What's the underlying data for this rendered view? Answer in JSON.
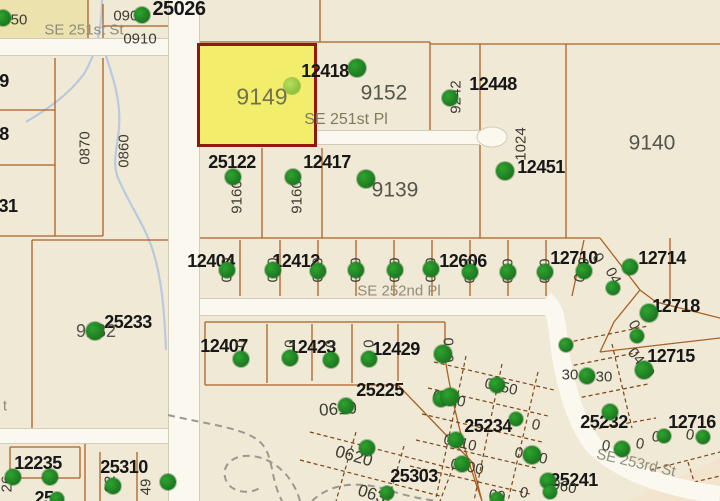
{
  "map": {
    "colors": {
      "background": "#f0e9d6",
      "parcel_line": "#aa6226",
      "road_fill": "#fbf8ef",
      "road_edge": "#d2cbb8",
      "stream": "#b9c9de",
      "highlight_fill": "#f2ee6b",
      "highlight_border": "#8d1a0f",
      "marker": "#1e8a1e",
      "marker_light": "#8ec63f",
      "label_bold": "#171717",
      "label_grey": "#55554a",
      "street": "#8f8c7a"
    },
    "selected_parcel": {
      "id": "9149",
      "x": 197,
      "y": 43,
      "w": 120,
      "h": 104
    },
    "labels": [
      {
        "t": "25026",
        "x": 179,
        "y": 9,
        "k": "p",
        "s": 20
      },
      {
        "t": "12418",
        "x": 325,
        "y": 71,
        "k": "p"
      },
      {
        "t": "12448",
        "x": 493,
        "y": 84,
        "k": "p"
      },
      {
        "t": "25122",
        "x": 232,
        "y": 162,
        "k": "p"
      },
      {
        "t": "12417",
        "x": 327,
        "y": 162,
        "k": "p"
      },
      {
        "t": "12451",
        "x": 541,
        "y": 167,
        "k": "p"
      },
      {
        "t": "12404",
        "x": 211,
        "y": 261,
        "k": "p"
      },
      {
        "t": "12412",
        "x": 296,
        "y": 261,
        "k": "p"
      },
      {
        "t": "12606",
        "x": 463,
        "y": 261,
        "k": "p"
      },
      {
        "t": "12710",
        "x": 574,
        "y": 258,
        "k": "p"
      },
      {
        "t": "12714",
        "x": 662,
        "y": 258,
        "k": "p"
      },
      {
        "t": "12718",
        "x": 676,
        "y": 306,
        "k": "p"
      },
      {
        "t": "25233",
        "x": 128,
        "y": 322,
        "k": "p"
      },
      {
        "t": "12407",
        "x": 224,
        "y": 346,
        "k": "p"
      },
      {
        "t": "12423",
        "x": 312,
        "y": 347,
        "k": "p"
      },
      {
        "t": "12429",
        "x": 396,
        "y": 349,
        "k": "p"
      },
      {
        "t": "25225",
        "x": 380,
        "y": 390,
        "k": "p"
      },
      {
        "t": "12715",
        "x": 671,
        "y": 356,
        "k": "p"
      },
      {
        "t": "25232",
        "x": 604,
        "y": 422,
        "k": "p"
      },
      {
        "t": "25234",
        "x": 488,
        "y": 426,
        "k": "p"
      },
      {
        "t": "25303",
        "x": 414,
        "y": 476,
        "k": "p"
      },
      {
        "t": "25241",
        "x": 574,
        "y": 480,
        "k": "p"
      },
      {
        "t": "12235",
        "x": 38,
        "y": 463,
        "k": "p"
      },
      {
        "t": "25310",
        "x": 124,
        "y": 467,
        "k": "p"
      },
      {
        "t": "12716",
        "x": 692,
        "y": 422,
        "k": "p"
      },
      {
        "t": "31",
        "x": 8,
        "y": 206,
        "k": "p"
      },
      {
        "t": "9",
        "x": 4,
        "y": 81,
        "k": "p"
      },
      {
        "t": "8",
        "x": 4,
        "y": 134,
        "k": "p"
      },
      {
        "t": "25",
        "x": 44,
        "y": 498,
        "k": "p"
      },
      {
        "t": "9149",
        "x": 262,
        "y": 97,
        "k": "p2",
        "s": 23,
        "c": "#72724f"
      },
      {
        "t": "9152",
        "x": 384,
        "y": 93,
        "k": "p2"
      },
      {
        "t": "9139",
        "x": 395,
        "y": 190,
        "k": "p2"
      },
      {
        "t": "9140",
        "x": 652,
        "y": 143,
        "k": "p2"
      },
      {
        "t": "9132",
        "x": 96,
        "y": 331,
        "k": "p2",
        "s": 18
      },
      {
        "t": "SE 251st St",
        "x": 84,
        "y": 30,
        "k": "st"
      },
      {
        "t": "SE 251st Pl",
        "x": 346,
        "y": 120,
        "k": "st",
        "s": 16,
        "c": "#7d7d5c"
      },
      {
        "t": "SE 252nd Pl",
        "x": 399,
        "y": 291,
        "k": "st"
      },
      {
        "t": "SE 253rd St",
        "x": 636,
        "y": 463,
        "k": "st",
        "r": 13
      },
      {
        "t": "t",
        "x": 5,
        "y": 406,
        "k": "st"
      },
      {
        "t": "0900",
        "x": 130,
        "y": 16,
        "k": "lot"
      },
      {
        "t": "0910",
        "x": 140,
        "y": 39,
        "k": "lot"
      },
      {
        "t": "50",
        "x": 19,
        "y": 20,
        "k": "lot"
      },
      {
        "t": "0870",
        "x": 85,
        "y": 148,
        "k": "lot",
        "r": -90
      },
      {
        "t": "0860",
        "x": 124,
        "y": 151,
        "k": "lot",
        "r": -90
      },
      {
        "t": "9160",
        "x": 237,
        "y": 197,
        "k": "lot",
        "r": -90
      },
      {
        "t": "9160",
        "x": 297,
        "y": 197,
        "k": "lot",
        "r": -90
      },
      {
        "t": "9242",
        "x": 456,
        "y": 97,
        "k": "lot",
        "r": -90
      },
      {
        "t": "1024",
        "x": 521,
        "y": 144,
        "k": "lot",
        "r": -90
      },
      {
        "t": "26",
        "x": 7,
        "y": 484,
        "k": "lot",
        "r": -90
      },
      {
        "t": "92",
        "x": 110,
        "y": 484,
        "k": "lot",
        "r": -90
      },
      {
        "t": "49",
        "x": 146,
        "y": 487,
        "k": "lot",
        "r": -90
      },
      {
        "t": "0  0",
        "x": 227,
        "y": 270,
        "k": "lot",
        "r": -90
      },
      {
        "t": "0  0",
        "x": 273,
        "y": 270,
        "k": "lot",
        "r": -90
      },
      {
        "t": "0  0",
        "x": 318,
        "y": 270,
        "k": "lot",
        "r": -90
      },
      {
        "t": "0  0",
        "x": 356,
        "y": 270,
        "k": "lot",
        "r": -90
      },
      {
        "t": "0  0",
        "x": 395,
        "y": 270,
        "k": "lot",
        "r": -90
      },
      {
        "t": "0  0",
        "x": 431,
        "y": 270,
        "k": "lot",
        "r": -90
      },
      {
        "t": "0  0",
        "x": 470,
        "y": 271,
        "k": "lot",
        "r": -90
      },
      {
        "t": "0  0",
        "x": 508,
        "y": 271,
        "k": "lot",
        "r": -90
      },
      {
        "t": "0  0",
        "x": 545,
        "y": 271,
        "k": "lot",
        "r": -90
      },
      {
        "t": "0  0",
        "x": 582,
        "y": 270,
        "k": "lot",
        "r": -75
      },
      {
        "t": "0  0",
        "x": 241,
        "y": 352,
        "k": "lot",
        "r": -90
      },
      {
        "t": "0  0",
        "x": 290,
        "y": 352,
        "k": "lot",
        "r": -90
      },
      {
        "t": "0  0",
        "x": 331,
        "y": 352,
        "k": "lot",
        "r": -90
      },
      {
        "t": "0  0",
        "x": 369,
        "y": 352,
        "k": "lot",
        "r": -90
      },
      {
        "t": "0  0",
        "x": 449,
        "y": 350,
        "k": "lot",
        "r": -90
      },
      {
        "t": "0",
        "x": 598,
        "y": 258,
        "k": "lot",
        "r": 60
      },
      {
        "t": "04",
        "x": 613,
        "y": 276,
        "k": "lot",
        "r": 62
      },
      {
        "t": "0",
        "x": 634,
        "y": 325,
        "k": "lot",
        "r": 62
      },
      {
        "t": "0410",
        "x": 641,
        "y": 363,
        "k": "lot",
        "r": 52
      },
      {
        "t": "30",
        "x": 570,
        "y": 375,
        "k": "lot"
      },
      {
        "t": "30",
        "x": 604,
        "y": 377,
        "k": "lot"
      },
      {
        "t": "0610",
        "x": 338,
        "y": 409,
        "k": "lot",
        "s": 17,
        "r": -4
      },
      {
        "t": "0620",
        "x": 354,
        "y": 456,
        "k": "lot",
        "s": 17,
        "r": 16
      },
      {
        "t": "063",
        "x": 372,
        "y": 494,
        "k": "lot",
        "s": 17,
        "r": 18
      },
      {
        "t": "0920",
        "x": 449,
        "y": 399,
        "k": "lot",
        "r": 13
      },
      {
        "t": "0950",
        "x": 501,
        "y": 387,
        "k": "lot",
        "r": 13
      },
      {
        "t": "0910",
        "x": 460,
        "y": 443,
        "k": "lot",
        "r": 13
      },
      {
        "t": "0900",
        "x": 467,
        "y": 467,
        "k": "lot",
        "r": 11
      },
      {
        "t": "0970",
        "x": 531,
        "y": 456,
        "k": "lot",
        "r": 13
      },
      {
        "t": "0960",
        "x": 560,
        "y": 486,
        "k": "lot",
        "r": 11
      },
      {
        "t": "0",
        "x": 536,
        "y": 425,
        "k": "lot",
        "r": 13
      },
      {
        "t": "09",
        "x": 497,
        "y": 496,
        "k": "lot",
        "r": 11
      },
      {
        "t": "0",
        "x": 524,
        "y": 493,
        "k": "lot",
        "r": 11
      },
      {
        "t": "0",
        "x": 606,
        "y": 446,
        "k": "lot",
        "r": 10
      },
      {
        "t": "0",
        "x": 640,
        "y": 444,
        "k": "lot",
        "r": 10
      },
      {
        "t": "0",
        "x": 656,
        "y": 437,
        "k": "lot",
        "r": 10
      },
      {
        "t": "0",
        "x": 690,
        "y": 435,
        "k": "lot",
        "r": 10
      }
    ],
    "markers": [
      {
        "x": 3,
        "y": 18
      },
      {
        "x": 142,
        "y": 15
      },
      {
        "x": 292,
        "y": 86,
        "lt": true
      },
      {
        "x": 357,
        "y": 68,
        "r": 9
      },
      {
        "x": 450,
        "y": 98
      },
      {
        "x": 505,
        "y": 171,
        "r": 9
      },
      {
        "x": 233,
        "y": 177
      },
      {
        "x": 293,
        "y": 177
      },
      {
        "x": 366,
        "y": 179,
        "r": 9
      },
      {
        "x": 95,
        "y": 331,
        "r": 9
      },
      {
        "x": 227,
        "y": 270
      },
      {
        "x": 273,
        "y": 270
      },
      {
        "x": 318,
        "y": 271
      },
      {
        "x": 356,
        "y": 270
      },
      {
        "x": 395,
        "y": 270
      },
      {
        "x": 431,
        "y": 269
      },
      {
        "x": 470,
        "y": 272
      },
      {
        "x": 508,
        "y": 272
      },
      {
        "x": 545,
        "y": 272
      },
      {
        "x": 584,
        "y": 271
      },
      {
        "x": 630,
        "y": 267
      },
      {
        "x": 649,
        "y": 313,
        "r": 9
      },
      {
        "x": 613,
        "y": 288,
        "r": 7
      },
      {
        "x": 637,
        "y": 336,
        "r": 7
      },
      {
        "x": 241,
        "y": 359
      },
      {
        "x": 290,
        "y": 358
      },
      {
        "x": 331,
        "y": 360
      },
      {
        "x": 369,
        "y": 359
      },
      {
        "x": 443,
        "y": 354,
        "r": 9
      },
      {
        "x": 441,
        "y": 399
      },
      {
        "x": 346,
        "y": 406
      },
      {
        "x": 367,
        "y": 448
      },
      {
        "x": 450,
        "y": 397,
        "r": 9
      },
      {
        "x": 497,
        "y": 385
      },
      {
        "x": 456,
        "y": 440
      },
      {
        "x": 462,
        "y": 464
      },
      {
        "x": 532,
        "y": 455,
        "r": 9
      },
      {
        "x": 548,
        "y": 481
      },
      {
        "x": 497,
        "y": 499,
        "r": 7
      },
      {
        "x": 387,
        "y": 493,
        "r": 7
      },
      {
        "x": 550,
        "y": 492,
        "r": 7
      },
      {
        "x": 516,
        "y": 419,
        "r": 7
      },
      {
        "x": 622,
        "y": 449
      },
      {
        "x": 664,
        "y": 436,
        "r": 7
      },
      {
        "x": 703,
        "y": 437,
        "r": 7
      },
      {
        "x": 587,
        "y": 376
      },
      {
        "x": 644,
        "y": 370,
        "r": 9
      },
      {
        "x": 610,
        "y": 412
      },
      {
        "x": 566,
        "y": 345,
        "r": 7
      },
      {
        "x": 13,
        "y": 477
      },
      {
        "x": 50,
        "y": 477
      },
      {
        "x": 113,
        "y": 486
      },
      {
        "x": 57,
        "y": 499,
        "r": 7
      },
      {
        "x": 168,
        "y": 482
      }
    ]
  }
}
